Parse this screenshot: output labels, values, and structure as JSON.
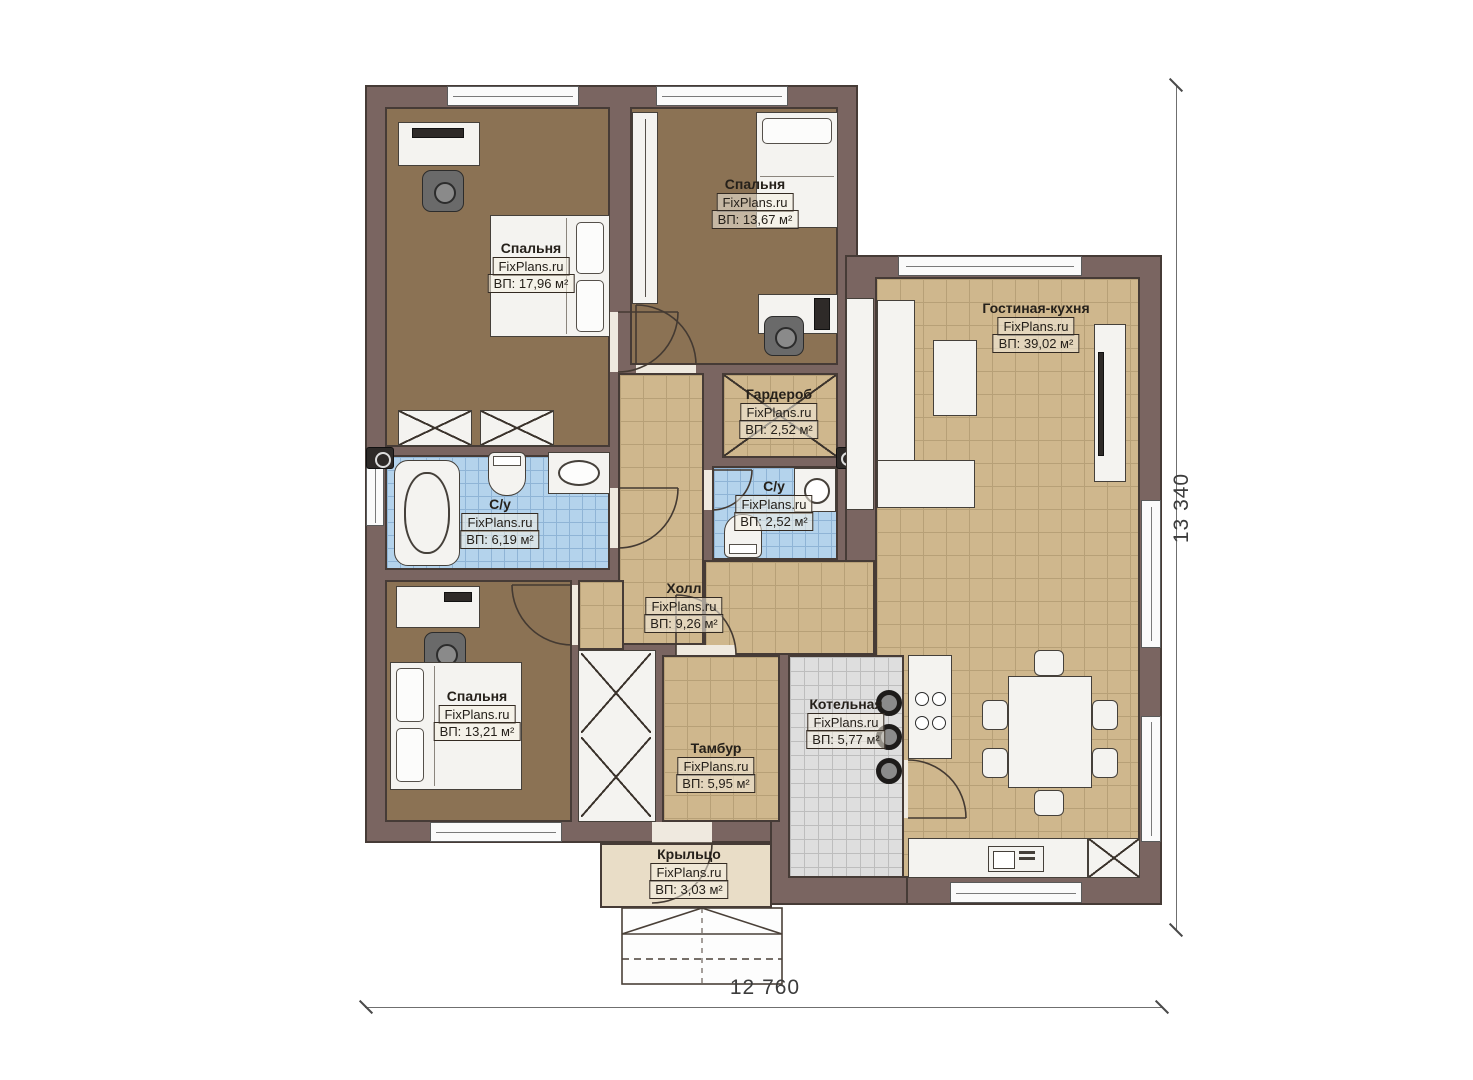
{
  "watermark": "FixPlans.ru",
  "dimensions": {
    "bottom": "12 760",
    "right": "13 340"
  },
  "rooms": [
    {
      "name": "Спальня",
      "watermark": "FixPlans.ru",
      "area": "ВП: 17,96 м²"
    },
    {
      "name": "Спальня",
      "watermark": "FixPlans.ru",
      "area": "ВП: 13,67 м²"
    },
    {
      "name": "Гостиная-кухня",
      "watermark": "FixPlans.ru",
      "area": "ВП: 39,02 м²"
    },
    {
      "name": "Гардероб",
      "watermark": "FixPlans.ru",
      "area": "ВП: 2,52 м²"
    },
    {
      "name": "С/у",
      "watermark": "FixPlans.ru",
      "area": "ВП: 2,52 м²"
    },
    {
      "name": "С/у",
      "watermark": "FixPlans.ru",
      "area": "ВП: 6,19 м²"
    },
    {
      "name": "Холл",
      "watermark": "FixPlans.ru",
      "area": "ВП: 9,26 м²"
    },
    {
      "name": "Спальня",
      "watermark": "FixPlans.ru",
      "area": "ВП: 13,21 м²"
    },
    {
      "name": "Котельная",
      "watermark": "FixPlans.ru",
      "area": "ВП: 5,77 м²"
    },
    {
      "name": "Тамбур",
      "watermark": "FixPlans.ru",
      "area": "ВП: 5,95 м²"
    },
    {
      "name": "Крыльцо",
      "watermark": "FixPlans.ru",
      "area": "ВП: 3,03 м²"
    }
  ],
  "colors": {
    "wall": "#7a6561",
    "wall_line": "#463b36",
    "floor_wood": "#8b7254",
    "floor_tile": "#cfb78d",
    "tile_line": "#b7a077",
    "floor_bath": "#b4d3ec",
    "bath_line": "#8fb4d6",
    "floor_boiler": "#dedede",
    "boiler_line": "#bdbdbd",
    "porch": "#e9ddc7",
    "furniture": "#f4f3f0",
    "furn_line": "#45403a",
    "label_ink": "#25201a",
    "dim_ink": "#3c3c3c"
  }
}
